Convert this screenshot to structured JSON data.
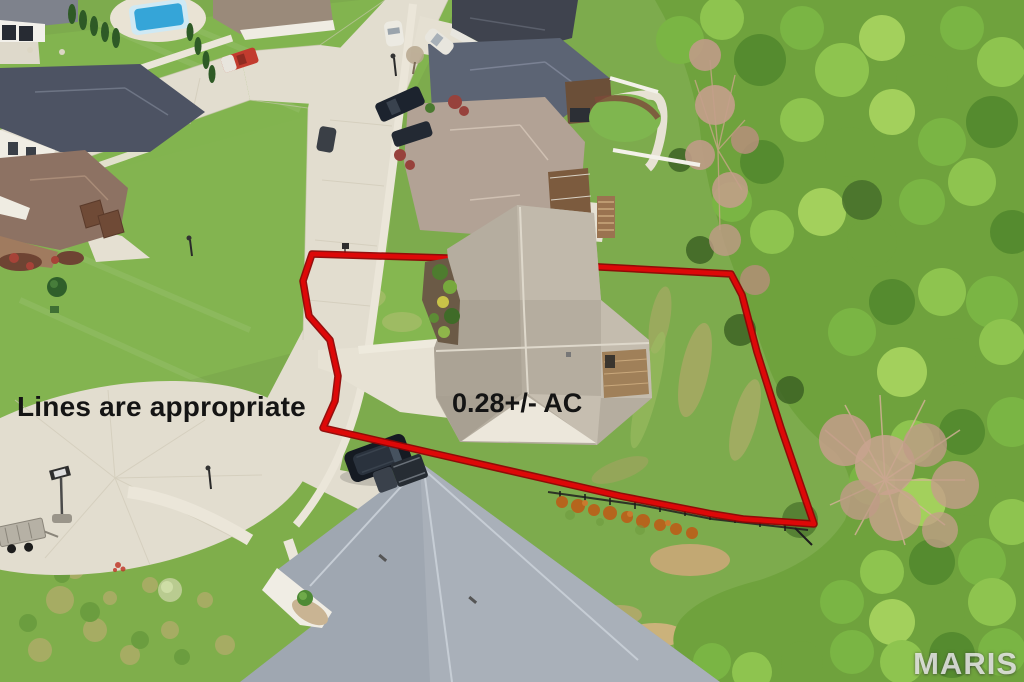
{
  "annotations": {
    "note_text": "Lines are appropriate",
    "acreage_text": "0.28+/- AC",
    "boundary_color": "#dd0808",
    "boundary_outline_color": "#8f0404"
  },
  "watermark": {
    "text": "MARIS"
  }
}
